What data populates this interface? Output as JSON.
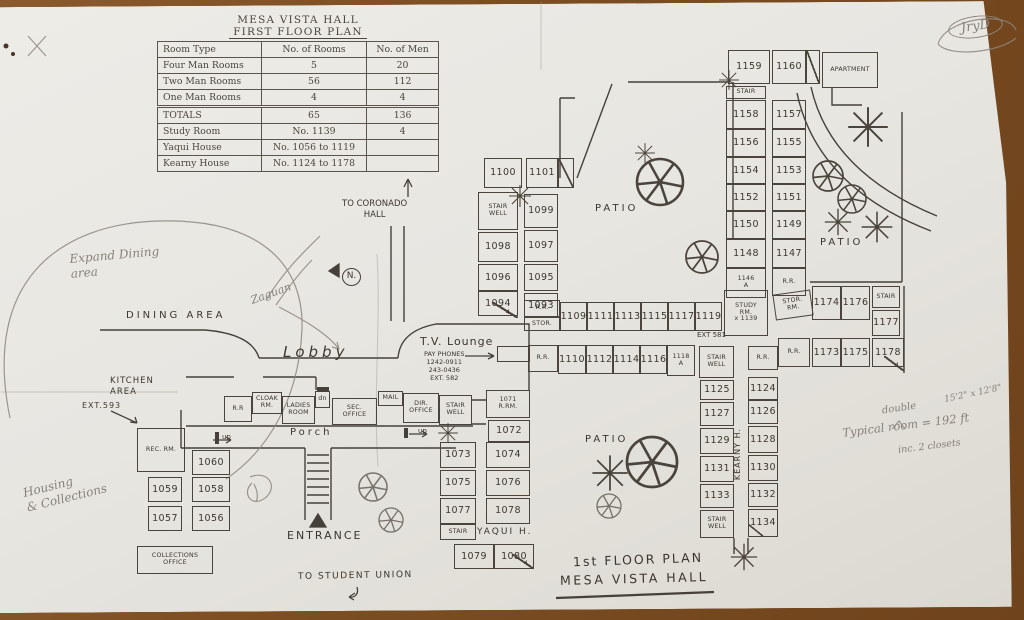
{
  "colors": {
    "ink": "#3c362e",
    "pencil": "#87817a",
    "paper": "#e8e6e1",
    "desk": "#7c4e22"
  },
  "stats_table": {
    "title_line1": "MESA VISTA HALL",
    "title_line2": "FIRST FLOOR PLAN",
    "headers": [
      "Room Type",
      "No. of Rooms",
      "No. of Men"
    ],
    "rows": [
      [
        "Four Man Rooms",
        "5",
        "20"
      ],
      [
        "Two Man Rooms",
        "56",
        "112"
      ],
      [
        "One Man Rooms",
        "4",
        "4"
      ]
    ],
    "totals_row": [
      "TOTALS",
      "65",
      "136"
    ],
    "extra_rows": [
      [
        "Study Room",
        "No. 1139",
        "4"
      ],
      [
        "Yaqui House",
        "No. 1056 to 1119",
        ""
      ],
      [
        "Kearny House",
        "No. 1124 to 1178",
        ""
      ]
    ]
  },
  "labels": [
    {
      "k": "dining-area",
      "t": "DINING  AREA",
      "x": 126,
      "y": 310,
      "fs": 10,
      "cls": "ink",
      "ls": 3
    },
    {
      "k": "kitchen-area",
      "t": "KITCHEN\nAREA",
      "x": 110,
      "y": 376,
      "fs": 8.5,
      "cls": "ink",
      "ls": 1
    },
    {
      "k": "ext-593",
      "t": "EXT.593",
      "x": 82,
      "y": 401,
      "fs": 8,
      "cls": "ink",
      "ls": 1
    },
    {
      "k": "lobby",
      "t": "Lobby",
      "x": 283,
      "y": 343,
      "fs": 15,
      "cls": "ink",
      "ls": 4,
      "it": 1
    },
    {
      "k": "tv-lounge",
      "t": "T.V. Lounge",
      "x": 420,
      "y": 335,
      "fs": 11,
      "cls": "ink",
      "ls": 1
    },
    {
      "k": "pay-phones",
      "t": "PAY PHONES\n1242-0911\n243-0436\nEXT. 582",
      "x": 424,
      "y": 350,
      "fs": 6.5,
      "cls": "ink ctr"
    },
    {
      "k": "porch",
      "t": "Porch",
      "x": 290,
      "y": 427,
      "fs": 10,
      "cls": "ink",
      "ls": 3
    },
    {
      "k": "up-left",
      "t": "up",
      "x": 222,
      "y": 433,
      "fs": 7,
      "cls": "ink"
    },
    {
      "k": "up-right",
      "t": "up",
      "x": 418,
      "y": 427,
      "fs": 7,
      "cls": "ink"
    },
    {
      "k": "entrance",
      "t": "ENTRANCE",
      "x": 287,
      "y": 529,
      "fs": 11,
      "cls": "ink",
      "ls": 2
    },
    {
      "k": "patio-center",
      "t": "PATIO",
      "x": 595,
      "y": 203,
      "fs": 10,
      "cls": "ink",
      "ls": 3
    },
    {
      "k": "patio-east",
      "t": "PATIO",
      "x": 820,
      "y": 237,
      "fs": 10,
      "cls": "ink",
      "ls": 3
    },
    {
      "k": "patio-south",
      "t": "PATIO",
      "x": 585,
      "y": 434,
      "fs": 10,
      "cls": "ink",
      "ls": 3
    },
    {
      "k": "yaqui-h",
      "t": "YAQUI  H.",
      "x": 477,
      "y": 527,
      "fs": 9,
      "cls": "ink",
      "ls": 2
    },
    {
      "k": "kearny-h",
      "t": "KEARNY  H.",
      "x": 733,
      "y": 428,
      "fs": 8,
      "cls": "ink vert",
      "ls": 1
    },
    {
      "k": "ext-581",
      "t": "EXT 581",
      "x": 697,
      "y": 331,
      "fs": 7,
      "cls": "ink"
    },
    {
      "k": "to-coronado",
      "t": "TO CORONADO\nHALL",
      "x": 342,
      "y": 199,
      "fs": 8.5,
      "cls": "ink ctr"
    },
    {
      "k": "to-student-union",
      "t": "TO STUDENT UNION",
      "x": 298,
      "y": 571,
      "fs": 9,
      "cls": "ink",
      "ls": 1.5,
      "rot": -1
    },
    {
      "k": "plan-title-1",
      "t": "1st FLOOR PLAN",
      "x": 573,
      "y": 552,
      "fs": 12.5,
      "cls": "ink",
      "ls": 2,
      "rot": -2
    },
    {
      "k": "plan-title-2",
      "t": "MESA VISTA HALL",
      "x": 560,
      "y": 571,
      "fs": 12.5,
      "cls": "ink",
      "ls": 2.5,
      "rot": -1.5
    },
    {
      "k": "jryd-initials",
      "t": "JryD",
      "x": 948,
      "y": 16,
      "fs": 13,
      "cls": "pencil circledE",
      "rot": -8
    },
    {
      "k": "expand-dining",
      "t": "Expand Dining\narea",
      "x": 70,
      "y": 248,
      "fs": 12,
      "cls": "pencil",
      "rot": -5
    },
    {
      "k": "zaguan",
      "t": "Zaguan",
      "x": 250,
      "y": 287,
      "fs": 11,
      "cls": "pencil",
      "rot": -20
    },
    {
      "k": "north-mark",
      "t": "N.",
      "x": 342,
      "y": 268,
      "fs": 9,
      "cls": "ink circledN"
    },
    {
      "k": "housing-collections",
      "t": "Housing\n& Collections",
      "x": 24,
      "y": 476,
      "fs": 12,
      "cls": "pencil",
      "rot": -14
    },
    {
      "k": "dim-note",
      "t": "15'2\" x 12'8\"",
      "x": 944,
      "y": 389,
      "fs": 9,
      "cls": "pencil",
      "rot": -12
    },
    {
      "k": "double-note",
      "t": "double",
      "x": 882,
      "y": 403,
      "fs": 10,
      "cls": "pencil",
      "rot": -8
    },
    {
      "k": "typical-room-note",
      "t": "Typical room = 192 ft",
      "x": 842,
      "y": 418,
      "fs": 11.5,
      "cls": "pencil",
      "rot": -7
    },
    {
      "k": "closets-note",
      "t": "inc. 2 closets",
      "x": 898,
      "y": 441,
      "fs": 9.5,
      "cls": "pencil",
      "rot": -7
    }
  ],
  "rooms": [
    {
      "t": "1100",
      "x": 484,
      "y": 158,
      "w": 38,
      "h": 30
    },
    {
      "t": "1101",
      "x": 526,
      "y": 158,
      "w": 32,
      "h": 30
    },
    {
      "t": "",
      "k": "door-1101",
      "x": 558,
      "y": 158,
      "w": 16,
      "h": 30,
      "d": 1
    },
    {
      "t": "STAIR\nWELL",
      "k": "stairwell-west",
      "x": 478,
      "y": 192,
      "w": 40,
      "h": 38,
      "s": 1
    },
    {
      "t": "1099",
      "x": 524,
      "y": 194,
      "w": 34,
      "h": 34
    },
    {
      "t": "1098",
      "x": 478,
      "y": 232,
      "w": 40,
      "h": 30
    },
    {
      "t": "1097",
      "x": 524,
      "y": 230,
      "w": 34,
      "h": 32
    },
    {
      "t": "1096",
      "x": 478,
      "y": 264,
      "w": 40,
      "h": 27
    },
    {
      "t": "1095",
      "x": 524,
      "y": 264,
      "w": 34,
      "h": 27
    },
    {
      "t": "1094",
      "x": 478,
      "y": 291,
      "w": 40,
      "h": 25
    },
    {
      "t": "1093",
      "x": 524,
      "y": 293,
      "w": 34,
      "h": 25
    },
    {
      "t": "4",
      "k": "stair4-west",
      "x": 492,
      "y": 302,
      "w": 26,
      "h": 16,
      "d": 1,
      "s": 1,
      "nb": 1
    },
    {
      "t": "R.R.",
      "k": "rr-rowA",
      "x": 524,
      "y": 300,
      "w": 36,
      "h": 17,
      "s": 1
    },
    {
      "t": "STOR.",
      "k": "stor-rowA",
      "x": 524,
      "y": 317,
      "w": 36,
      "h": 14,
      "s": 1
    },
    {
      "t": "1109",
      "x": 560,
      "y": 302,
      "w": 27,
      "h": 29
    },
    {
      "t": "1111",
      "x": 587,
      "y": 302,
      "w": 27,
      "h": 29
    },
    {
      "t": "1113",
      "x": 614,
      "y": 302,
      "w": 27,
      "h": 29
    },
    {
      "t": "1115",
      "x": 641,
      "y": 302,
      "w": 27,
      "h": 29
    },
    {
      "t": "1117",
      "x": 668,
      "y": 302,
      "w": 27,
      "h": 29
    },
    {
      "t": "1119",
      "x": 695,
      "y": 302,
      "w": 27,
      "h": 29
    },
    {
      "t": "R.R.",
      "k": "rr-rowB",
      "x": 528,
      "y": 345,
      "w": 30,
      "h": 27,
      "s": 1
    },
    {
      "t": "1110",
      "x": 558,
      "y": 345,
      "w": 28,
      "h": 29
    },
    {
      "t": "1112",
      "x": 586,
      "y": 345,
      "w": 27,
      "h": 29
    },
    {
      "t": "1114",
      "x": 613,
      "y": 345,
      "w": 27,
      "h": 29
    },
    {
      "t": "1116",
      "x": 640,
      "y": 345,
      "w": 27,
      "h": 29
    },
    {
      "t": "1118\nA",
      "x": 667,
      "y": 345,
      "w": 28,
      "h": 31,
      "s": 1
    },
    {
      "t": "STAIR\nWELL",
      "k": "stairwell-kearny-top",
      "x": 699,
      "y": 346,
      "w": 35,
      "h": 32,
      "s": 1
    },
    {
      "t": "STUDY\nRM.\nx 1139",
      "k": "study-rm-1139",
      "x": 724,
      "y": 290,
      "w": 44,
      "h": 46,
      "s": 1
    },
    {
      "t": "STOR.\nRM.",
      "k": "stor-rm-east",
      "x": 774,
      "y": 292,
      "w": 38,
      "h": 26,
      "s": 1,
      "r": -8
    },
    {
      "t": "1174",
      "x": 812,
      "y": 286,
      "w": 29,
      "h": 34
    },
    {
      "t": "1176",
      "x": 841,
      "y": 286,
      "w": 29,
      "h": 34
    },
    {
      "t": "STAIR",
      "k": "stair-east",
      "x": 872,
      "y": 286,
      "w": 28,
      "h": 22,
      "s": 1
    },
    {
      "t": "1177",
      "x": 872,
      "y": 310,
      "w": 28,
      "h": 26
    },
    {
      "t": "R.R.",
      "k": "rr-east",
      "x": 778,
      "y": 338,
      "w": 32,
      "h": 29,
      "s": 1
    },
    {
      "t": "1173",
      "x": 812,
      "y": 338,
      "w": 29,
      "h": 29
    },
    {
      "t": "1175",
      "x": 841,
      "y": 338,
      "w": 29,
      "h": 29
    },
    {
      "t": "1178",
      "x": 872,
      "y": 338,
      "w": 32,
      "h": 29
    },
    {
      "t": "4",
      "k": "door-1178",
      "x": 884,
      "y": 356,
      "w": 20,
      "h": 15,
      "d": 1,
      "s": 1,
      "nb": 1
    },
    {
      "t": "1159",
      "x": 728,
      "y": 50,
      "w": 42,
      "h": 34
    },
    {
      "t": "1160",
      "x": 772,
      "y": 50,
      "w": 34,
      "h": 34
    },
    {
      "t": "",
      "k": "door-1160",
      "x": 806,
      "y": 50,
      "w": 14,
      "h": 34,
      "d": 1
    },
    {
      "t": "APARTMENT",
      "x": 822,
      "y": 52,
      "w": 56,
      "h": 36,
      "s": 1
    },
    {
      "t": "STAIR",
      "k": "stair-north",
      "x": 726,
      "y": 86,
      "w": 40,
      "h": 13,
      "s": 1
    },
    {
      "t": "1158",
      "x": 726,
      "y": 100,
      "w": 40,
      "h": 29
    },
    {
      "t": "1157",
      "x": 772,
      "y": 100,
      "w": 34,
      "h": 29
    },
    {
      "t": "1156",
      "x": 726,
      "y": 129,
      "w": 40,
      "h": 28
    },
    {
      "t": "1155",
      "x": 772,
      "y": 129,
      "w": 34,
      "h": 28
    },
    {
      "t": "1154",
      "x": 726,
      "y": 157,
      "w": 40,
      "h": 27
    },
    {
      "t": "1153",
      "x": 772,
      "y": 157,
      "w": 34,
      "h": 27
    },
    {
      "t": "1152",
      "x": 726,
      "y": 184,
      "w": 40,
      "h": 27
    },
    {
      "t": "1151",
      "x": 772,
      "y": 184,
      "w": 34,
      "h": 27
    },
    {
      "t": "1150",
      "x": 726,
      "y": 211,
      "w": 40,
      "h": 28
    },
    {
      "t": "1149",
      "x": 772,
      "y": 211,
      "w": 34,
      "h": 28
    },
    {
      "t": "1148",
      "x": 726,
      "y": 239,
      "w": 40,
      "h": 29
    },
    {
      "t": "1147",
      "x": 772,
      "y": 239,
      "w": 34,
      "h": 29
    },
    {
      "t": "1146\nA",
      "x": 726,
      "y": 268,
      "w": 40,
      "h": 30,
      "s": 1
    },
    {
      "t": "R.R.",
      "k": "rr-north",
      "x": 772,
      "y": 268,
      "w": 34,
      "h": 28,
      "s": 1
    },
    {
      "t": "R.R.",
      "k": "rr-kearny-top",
      "x": 748,
      "y": 346,
      "w": 30,
      "h": 24,
      "s": 1
    },
    {
      "t": "1125",
      "x": 700,
      "y": 380,
      "w": 34,
      "h": 20
    },
    {
      "t": "1124",
      "x": 748,
      "y": 377,
      "w": 30,
      "h": 23
    },
    {
      "t": "1127",
      "x": 700,
      "y": 402,
      "w": 34,
      "h": 24
    },
    {
      "t": "1126",
      "x": 748,
      "y": 400,
      "w": 30,
      "h": 24
    },
    {
      "t": "1129",
      "x": 700,
      "y": 428,
      "w": 34,
      "h": 26
    },
    {
      "t": "1128",
      "x": 748,
      "y": 426,
      "w": 30,
      "h": 27
    },
    {
      "t": "1131",
      "x": 700,
      "y": 456,
      "w": 34,
      "h": 26
    },
    {
      "t": "1130",
      "x": 748,
      "y": 455,
      "w": 30,
      "h": 26
    },
    {
      "t": "1133",
      "x": 700,
      "y": 484,
      "w": 34,
      "h": 24
    },
    {
      "t": "1132",
      "x": 748,
      "y": 483,
      "w": 30,
      "h": 24
    },
    {
      "t": "STAIR\nWELL",
      "k": "stairwell-kearny-south",
      "x": 700,
      "y": 510,
      "w": 34,
      "h": 28,
      "s": 1
    },
    {
      "t": "1134",
      "x": 748,
      "y": 509,
      "w": 30,
      "h": 28
    },
    {
      "t": "",
      "k": "door-1134",
      "x": 748,
      "y": 524,
      "w": 16,
      "h": 13,
      "d": 1,
      "nb": 1
    },
    {
      "t": "1071\nR.RM.",
      "x": 486,
      "y": 390,
      "w": 44,
      "h": 28,
      "s": 1
    },
    {
      "t": "1072",
      "x": 488,
      "y": 420,
      "w": 42,
      "h": 22
    },
    {
      "t": "1073",
      "x": 440,
      "y": 442,
      "w": 36,
      "h": 26
    },
    {
      "t": "1074",
      "x": 486,
      "y": 442,
      "w": 44,
      "h": 26
    },
    {
      "t": "1075",
      "x": 440,
      "y": 470,
      "w": 36,
      "h": 26
    },
    {
      "t": "1076",
      "x": 486,
      "y": 470,
      "w": 44,
      "h": 26
    },
    {
      "t": "1077",
      "x": 440,
      "y": 498,
      "w": 36,
      "h": 26
    },
    {
      "t": "1078",
      "x": 486,
      "y": 498,
      "w": 44,
      "h": 26
    },
    {
      "t": "STAIR",
      "k": "stair-yaqui",
      "x": 440,
      "y": 524,
      "w": 36,
      "h": 16,
      "s": 1
    },
    {
      "t": "1079",
      "x": 454,
      "y": 544,
      "w": 40,
      "h": 25
    },
    {
      "t": "1080",
      "x": 494,
      "y": 544,
      "w": 40,
      "h": 25
    },
    {
      "t": "4",
      "k": "door-1080",
      "x": 512,
      "y": 554,
      "w": 22,
      "h": 15,
      "d": 1,
      "s": 1,
      "nb": 1
    },
    {
      "t": "R.R",
      "k": "rr-office",
      "x": 224,
      "y": 396,
      "w": 28,
      "h": 26,
      "s": 1
    },
    {
      "t": "CLOAK\nRM.",
      "x": 252,
      "y": 392,
      "w": 30,
      "h": 22,
      "s": 1
    },
    {
      "t": "LADIES\nROOM",
      "x": 282,
      "y": 396,
      "w": 33,
      "h": 28,
      "s": 1
    },
    {
      "t": "dn",
      "x": 315,
      "y": 391,
      "w": 15,
      "h": 17,
      "s": 1
    },
    {
      "t": "SEC.\nOFFICE",
      "x": 332,
      "y": 398,
      "w": 45,
      "h": 27,
      "s": 1
    },
    {
      "t": "MAIL",
      "x": 378,
      "y": 391,
      "w": 25,
      "h": 15,
      "s": 1
    },
    {
      "t": "DIR.\nOFFICE",
      "x": 403,
      "y": 393,
      "w": 36,
      "h": 30,
      "s": 1
    },
    {
      "t": "STAIR\nWELL",
      "k": "stairwell-office",
      "x": 439,
      "y": 395,
      "w": 33,
      "h": 30,
      "s": 1
    },
    {
      "t": "REC. RM.",
      "x": 137,
      "y": 428,
      "w": 48,
      "h": 44,
      "s": 1
    },
    {
      "t": "1060",
      "x": 192,
      "y": 450,
      "w": 38,
      "h": 25
    },
    {
      "t": "1059",
      "x": 148,
      "y": 477,
      "w": 34,
      "h": 25
    },
    {
      "t": "1058",
      "x": 192,
      "y": 477,
      "w": 38,
      "h": 25
    },
    {
      "t": "1057",
      "x": 148,
      "y": 506,
      "w": 34,
      "h": 25
    },
    {
      "t": "1056",
      "x": 192,
      "y": 506,
      "w": 38,
      "h": 25
    },
    {
      "t": "COLLECTIONS\nOFFICE",
      "x": 137,
      "y": 546,
      "w": 76,
      "h": 28,
      "s": 1
    },
    {
      "t": "",
      "k": "payphone-box",
      "x": 497,
      "y": 346,
      "w": 33,
      "h": 16
    }
  ]
}
